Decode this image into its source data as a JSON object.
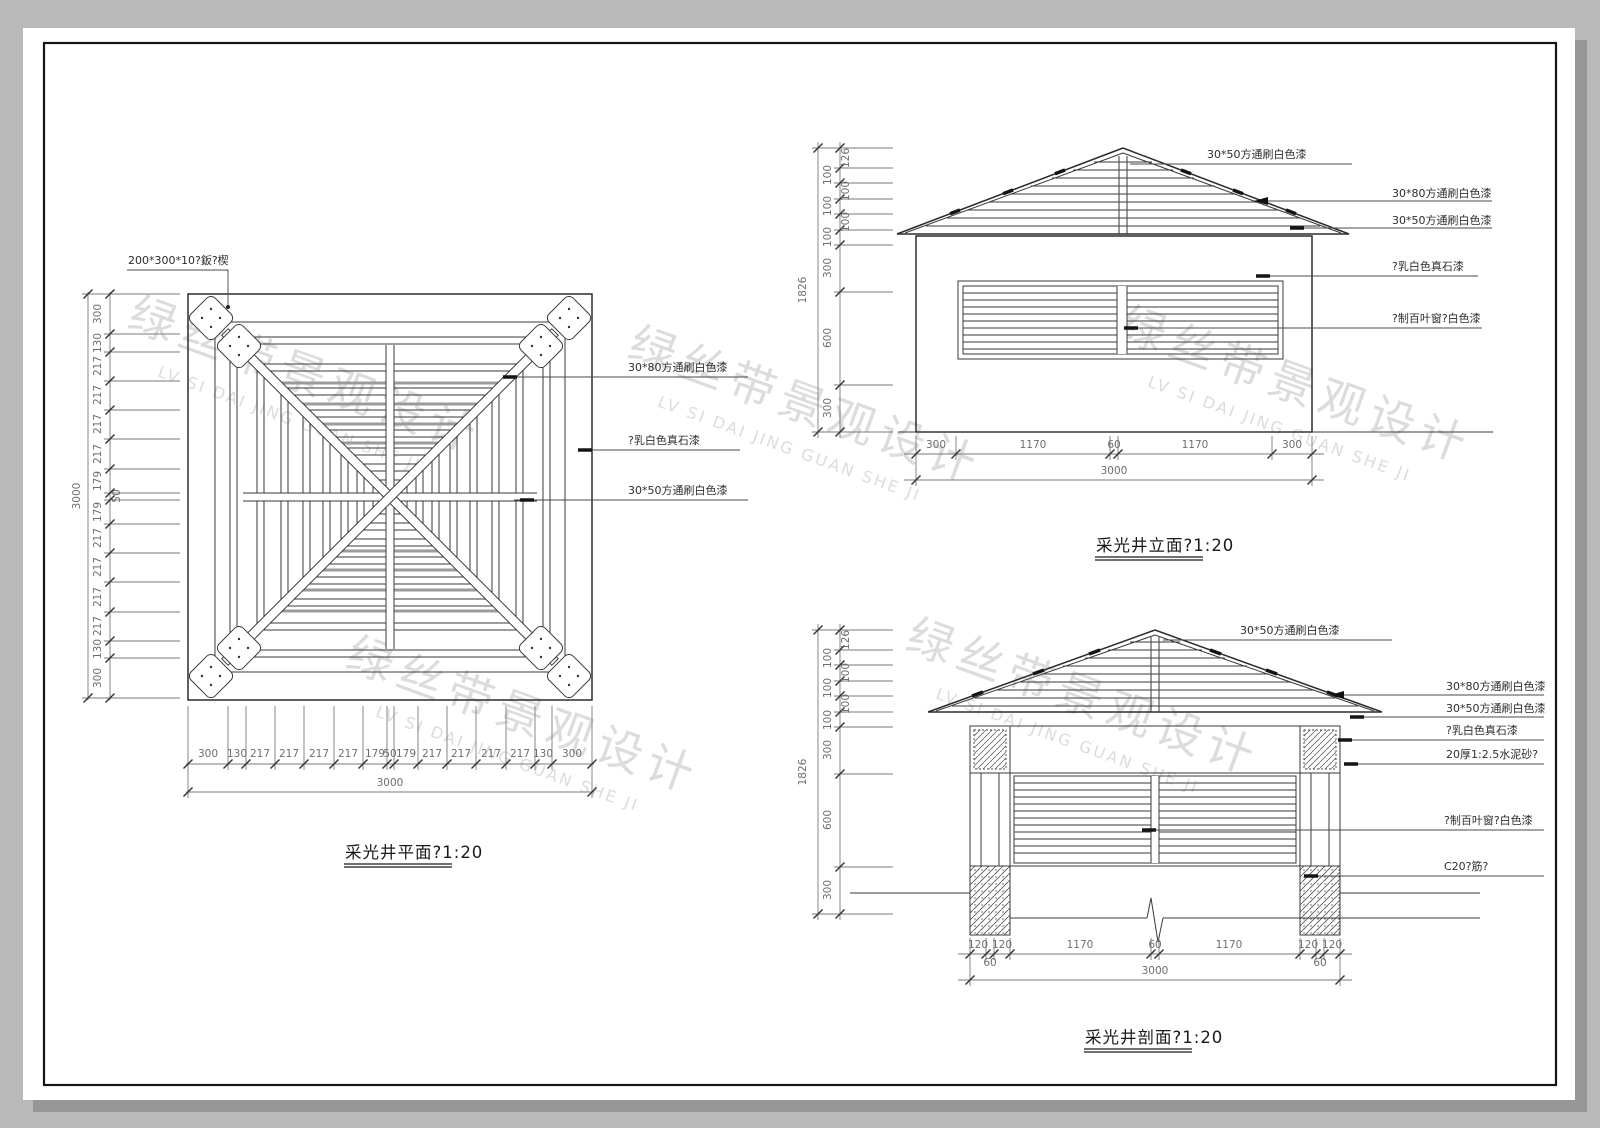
{
  "watermark": {
    "cn": "绿丝带景观设计",
    "en": "LV SI DAI JING GUAN SHE JI"
  },
  "plan": {
    "title": "采光井平面?1:20",
    "labels": {
      "plate": "200*300*10?鈑?楔",
      "tube_3080": "30*80方通刷白色漆",
      "stone": "?乳白色真石漆",
      "tube_3050": "30*50方通刷白色漆"
    },
    "dims": {
      "segments": [
        "300",
        "130",
        "217",
        "217",
        "217",
        "217",
        "179",
        "50",
        "179",
        "217",
        "217",
        "217",
        "217",
        "130",
        "300"
      ],
      "total": "3000"
    }
  },
  "elevation": {
    "title": "采光井立面?1:20",
    "labels": {
      "tube_3050_top": "30*50方通刷白色漆",
      "tube_3080": "30*80方通刷白色漆",
      "tube_3050": "30*50方通刷白色漆",
      "stone": "?乳白色真石漆",
      "louver": "?制百叶窗?白色漆"
    },
    "dims": {
      "left": [
        "126",
        "100",
        "100",
        "100",
        "100",
        "100",
        "300",
        "600",
        "300"
      ],
      "left_total": "1826",
      "bottom": [
        "300",
        "1170",
        "60",
        "1170",
        "300"
      ],
      "bottom_total": "3000"
    }
  },
  "section": {
    "title": "采光井剖面?1:20",
    "labels": {
      "tube_3050_top": "30*50方通刷白色漆",
      "tube_3080": "30*80方通刷白色漆",
      "tube_3050": "30*50方通刷白色漆",
      "stone": "?乳白色真石漆",
      "mortar": "20厚1:2.5水泥砂?",
      "louver": "?制百叶窗?白色漆",
      "concrete": "C20?筋?"
    },
    "dims": {
      "left": [
        "126",
        "100",
        "100",
        "100",
        "100",
        "100",
        "300",
        "600",
        "300"
      ],
      "left_total": "1826",
      "bottom": [
        "120",
        "120",
        "1170",
        "60",
        "1170",
        "120",
        "120"
      ],
      "bottom_sub": [
        "60",
        "60"
      ],
      "bottom_total": "3000"
    }
  }
}
